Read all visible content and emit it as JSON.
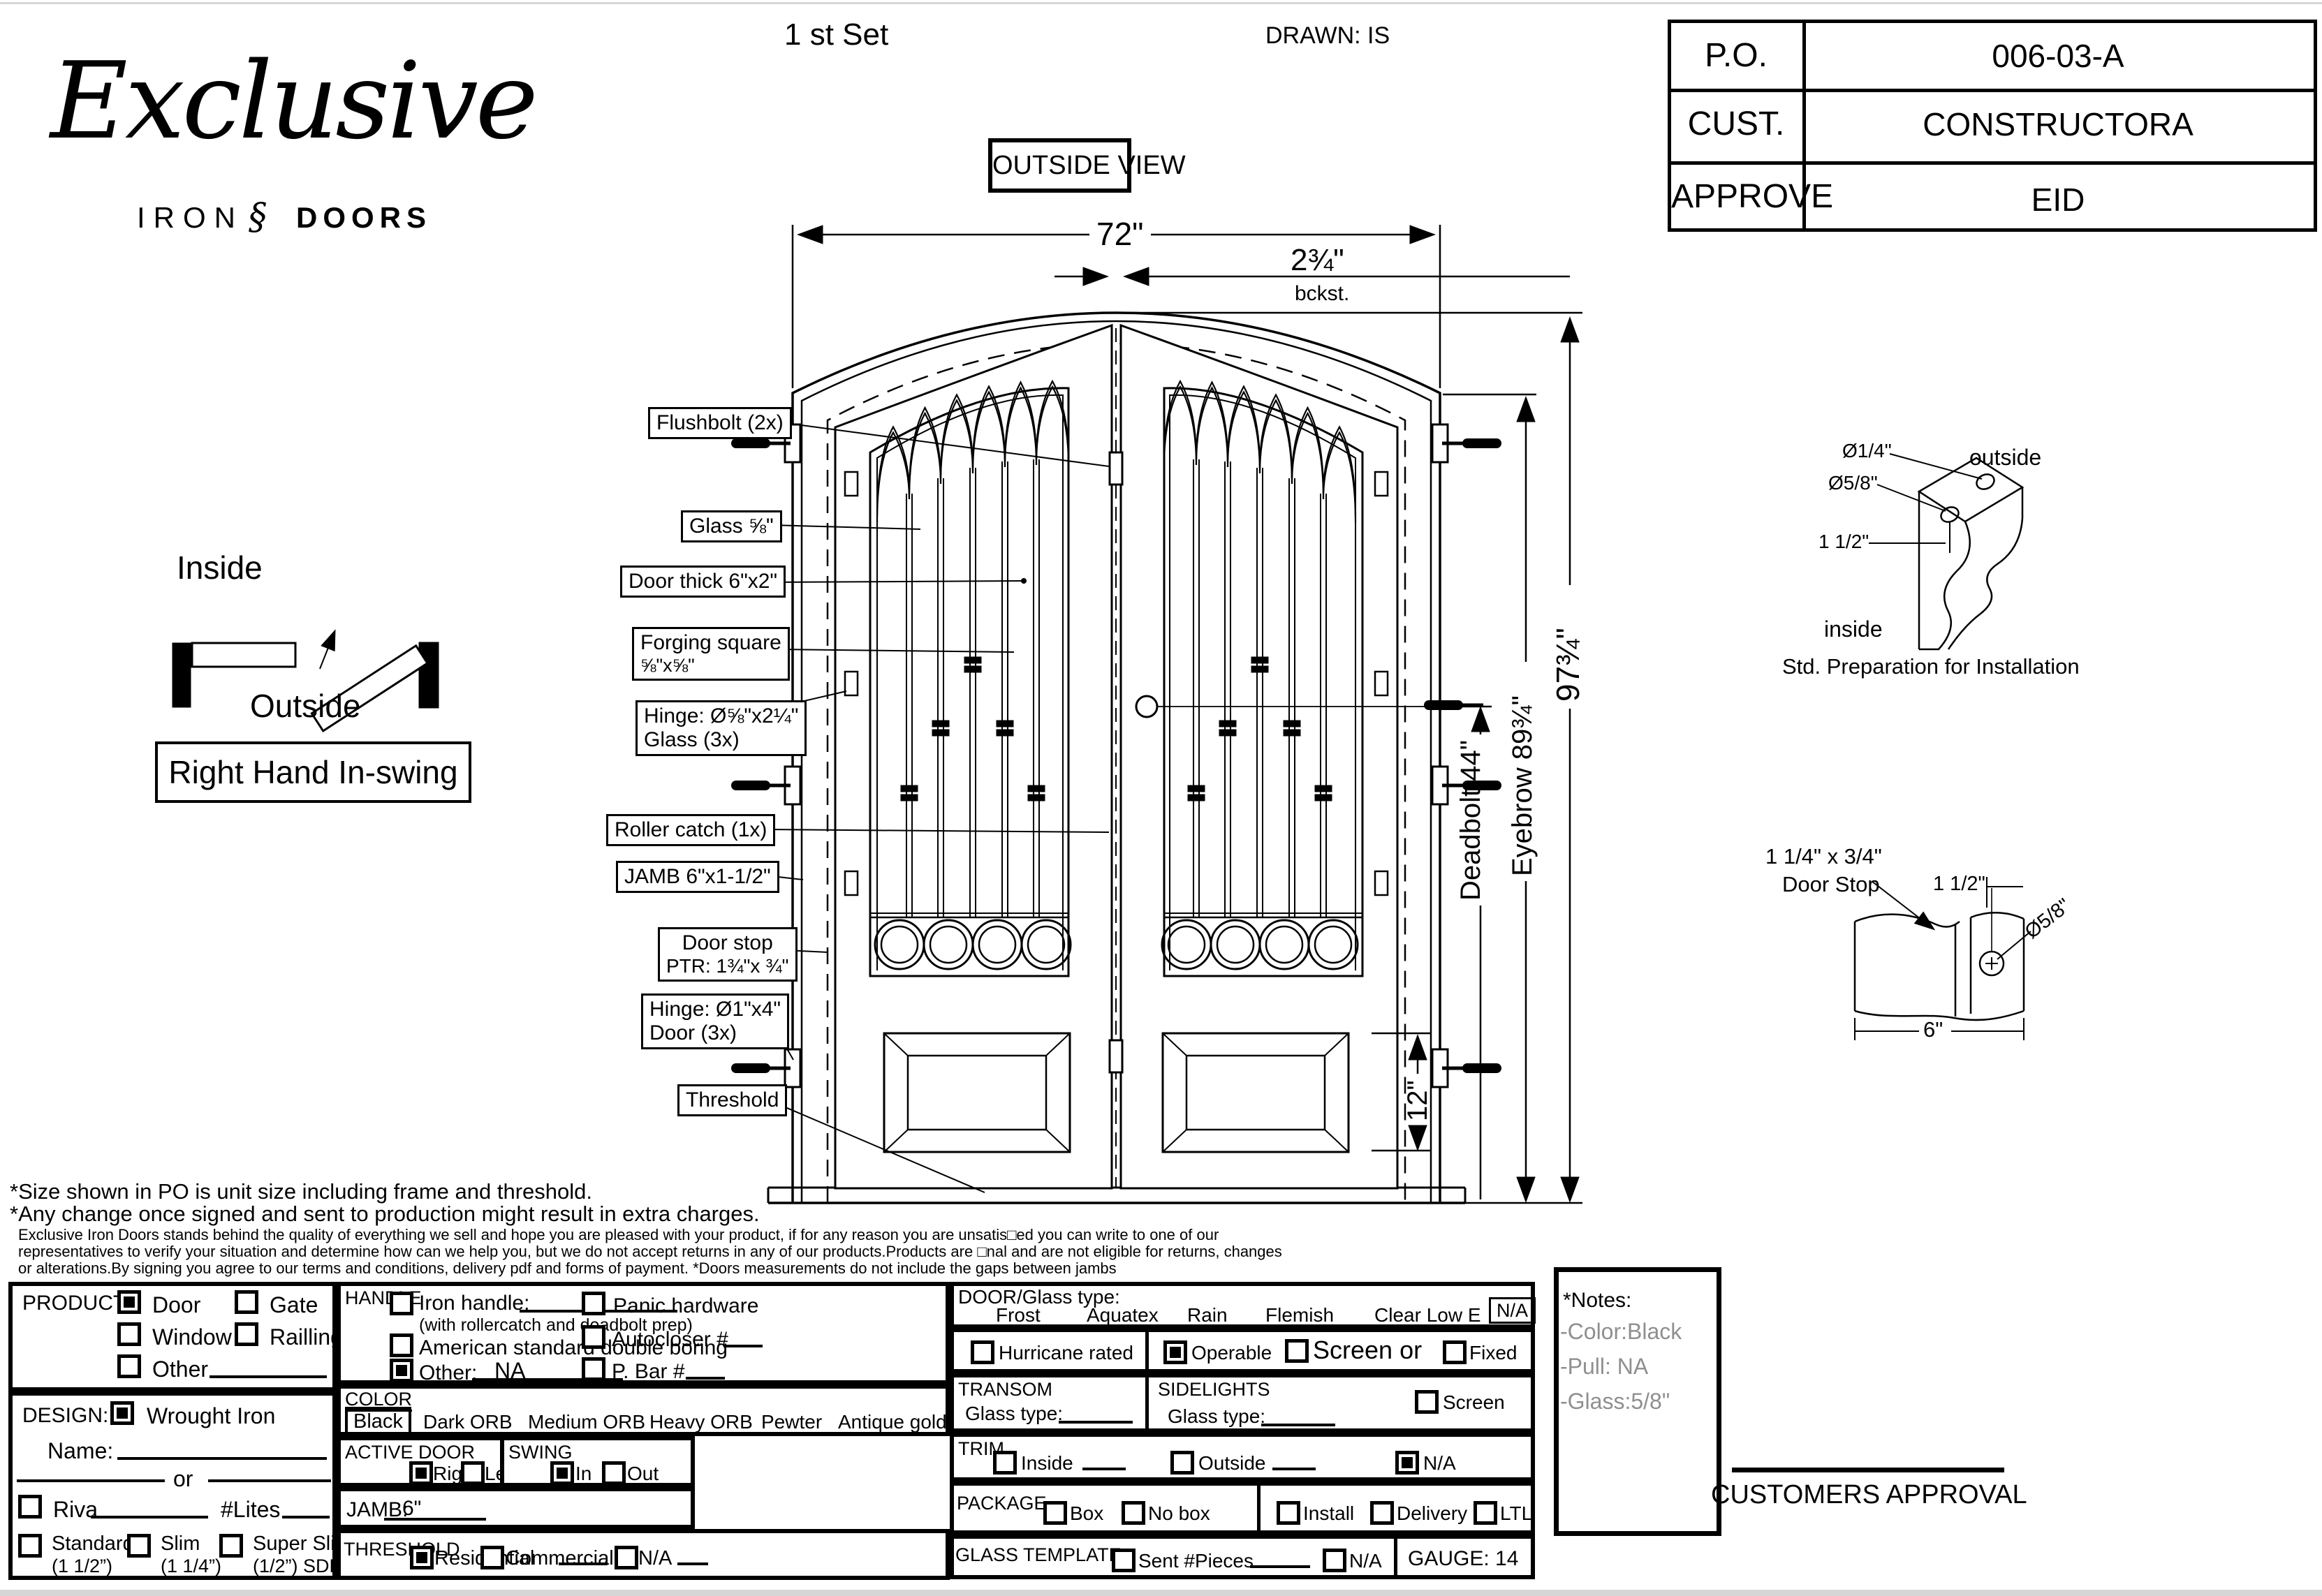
{
  "page": {
    "set_label": "1 st Set",
    "drawn_label": "DRAWN: IS",
    "outside_view": "OUTSIDE VIEW"
  },
  "logo": {
    "script": "Exclusive",
    "iron": "IRON",
    "ornament": "§",
    "doors": "DOORS"
  },
  "po_table": {
    "rows": [
      {
        "label": "P.O.",
        "value": "006-03-A"
      },
      {
        "label": "CUST.",
        "value": "CONSTRUCTORA"
      },
      {
        "label": "APPROVE",
        "value": "EID"
      }
    ]
  },
  "swing_diagram": {
    "inside": "Inside",
    "outside": "Outside",
    "caption": "Right Hand In-swing"
  },
  "dims": {
    "width": "72\"",
    "backset": "2¾\"",
    "backset_sub": "bckst.",
    "height": "97¾\"",
    "eyebrow": "Eyebrow 89¾\"",
    "deadbolt": "Deadbolt 44\"",
    "panel": "12\""
  },
  "callouts": {
    "flushbolt": "Flushbolt (2x)",
    "glass": "Glass ⅝\"",
    "door_thick": "Door thick 6\"x2\"",
    "forging1": "Forging square",
    "forging2": "⅝\"x⅝\"",
    "hinge_glass1": "Hinge: Ø⅝\"x2¼\"",
    "hinge_glass2": "Glass (3x)",
    "roller": "Roller catch  (1x)",
    "jamb": "JAMB  6\"x1-1/2\"",
    "door_stop1": "Door stop",
    "door_stop2": "PTR: 1¾\"x ¾\"",
    "hinge_door1": "Hinge: Ø1\"x4\"",
    "hinge_door2": "Door (3x)",
    "threshold": "Threshold"
  },
  "install_diagram": {
    "d1": "Ø1/4\"",
    "d2": "Ø5/8\"",
    "outside": "outside",
    "dim": "1 1/2\"",
    "inside": "inside",
    "caption": "Std. Preparation for Installation"
  },
  "doorstop_diagram": {
    "t1": "1 1/4\" x 3/4\"",
    "t2": "Door Stop",
    "dim_top": "1 1/2\"",
    "dia": "Ø5/8\"",
    "dim_bottom": "6\""
  },
  "disclaimer": {
    "l1": "*Size shown in PO is unit size including frame and threshold.",
    "l2": "*Any change once signed and sent to production might result in extra charges.",
    "l3": "Exclusive Iron Doors stands behind the quality of everything we sell and hope you are pleased with your product, if for any reason you are unsatis□ed you can write to one of our",
    "l4": "representatives to verify your situation and determine how can we help you, but we do not accept returns in any of our products.Products are □nal and are not eligible for returns, changes",
    "l5": "or alterations.By signing you agree to our terms and conditions, delivery pdf and forms of payment. *Doors measurements do not include the gaps between jambs"
  },
  "form": {
    "product": {
      "title": "PRODUCT:",
      "door": "Door",
      "gate": "Gate",
      "window": "Window",
      "railing": "Railling",
      "other": "Other"
    },
    "design": {
      "title": "DESIGN:",
      "wrought_iron": "Wrought Iron",
      "name": "Name:",
      "or": "or",
      "riva": "Riva",
      "lites": "#Lites",
      "standard": "Standard",
      "standard_sub": "(1 1/2”)",
      "slim": "Slim",
      "slim_sub": "(1 1/4”)",
      "super_slim": "Super Slim",
      "super_slim_sub": "(1/2”) SDL"
    },
    "handle": {
      "title": "HANDLE",
      "iron_handle": "Iron handle:",
      "iron_sub": "(with rollercatch and deadbolt prep)",
      "american": "American standard double boring",
      "other": "Other:",
      "other_value": "NA",
      "panic": "Panic hardware",
      "autocloser": "Autocloser #",
      "pbar": "P. Bar #"
    },
    "color": {
      "title": "COLOR",
      "selected": "Black",
      "opt1": "Dark ORB",
      "opt2": "Medium ORB",
      "opt3": "Heavy ORB",
      "opt4": "Pewter",
      "opt5": "Antique gold"
    },
    "active_door": {
      "title": "ACTIVE DOOR",
      "right": "Right",
      "left": "Left"
    },
    "swing": {
      "title": "SWING",
      "in": "In",
      "out": "Out"
    },
    "jamb": {
      "title": "JAMB:",
      "value": "6\""
    },
    "threshold": {
      "title": "THRESHOLD",
      "residential": "Residential",
      "commercial": "Commercial",
      "na": "N/A"
    },
    "glass": {
      "title": "DOOR/Glass type:",
      "frost": "Frost",
      "aquatex": "Aquatex",
      "rain": "Rain",
      "flemish": "Flemish",
      "clear_low_e": "Clear Low E",
      "na": "N/A"
    },
    "hurricane": "Hurricane rated",
    "operable": "Operable",
    "screen_or": "Screen or",
    "fixed": "Fixed",
    "transom": {
      "title": "TRANSOM",
      "glass_type": "Glass type:"
    },
    "sidelights": {
      "title": "SIDELIGHTS",
      "glass_type": "Glass type:",
      "screen": "Screen"
    },
    "trim": {
      "title": "TRIM",
      "inside": "Inside",
      "outside": "Outside",
      "na": "N/A"
    },
    "package": {
      "title": "PACKAGE",
      "box": "Box",
      "no_box": "No box",
      "install": "Install",
      "delivery": "Delivery",
      "ltl": "LTL"
    },
    "glass_template": {
      "title": "GLASS TEMPLATE",
      "sent": "Sent #Pieces",
      "na": "N/A"
    },
    "gauge": "GAUGE: 14",
    "notes": {
      "title": "*Notes:",
      "l1": "-Color:Black",
      "l2": "-Pull: NA",
      "l3": "-Glass:5/8\""
    },
    "approval": "CUSTOMERS APPROVAL"
  },
  "checked": {
    "product_door": true,
    "product_gate": false,
    "product_window": false,
    "product_railing": false,
    "product_other": false,
    "design_wrought_iron": true,
    "design_riva": false,
    "design_standard": false,
    "design_slim": false,
    "design_super_slim": false,
    "handle_iron": false,
    "handle_american": false,
    "handle_other": true,
    "handle_panic": false,
    "handle_autocloser": false,
    "handle_pbar": false,
    "active_right": true,
    "active_left": false,
    "swing_in": true,
    "swing_out": false,
    "threshold_residential": true,
    "threshold_commercial": false,
    "threshold_na": false,
    "hurricane": false,
    "operable": true,
    "screen_or": false,
    "fixed": false,
    "sidelights_screen": false,
    "trim_inside": false,
    "trim_outside": false,
    "trim_na": true,
    "package_box": false,
    "package_nobox": false,
    "package_install": false,
    "package_delivery": false,
    "package_ltl": false,
    "template_sent": false,
    "template_na": false
  }
}
